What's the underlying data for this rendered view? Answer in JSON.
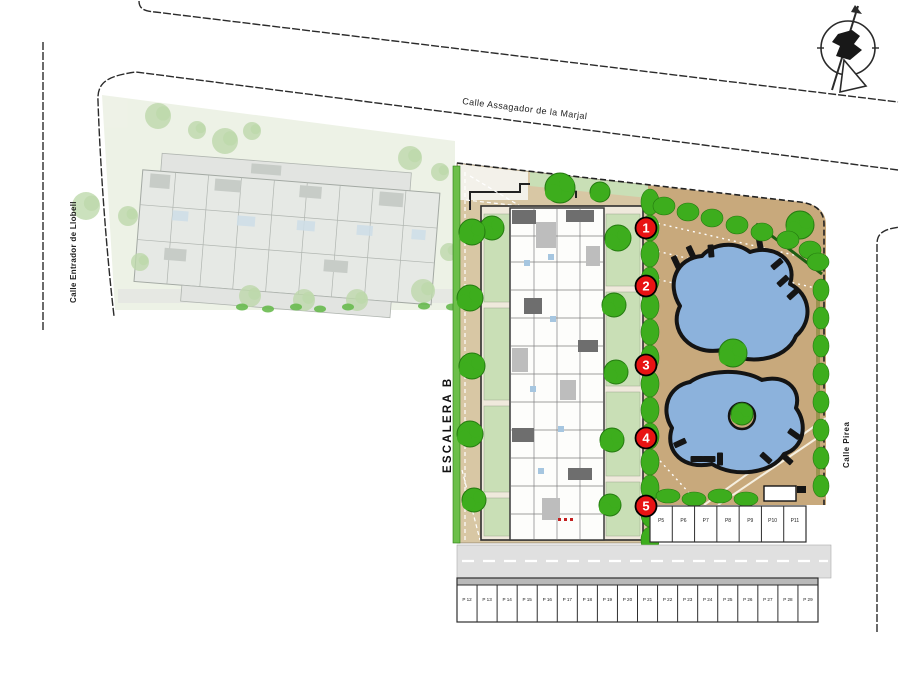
{
  "plan": {
    "staircase_label": "ESCALERA B",
    "unit_badges": [
      "1",
      "2",
      "3",
      "4",
      "5"
    ]
  },
  "streets": {
    "top": "Calle Assagador de la Marjal",
    "left": "Calle Entrador de Llobell",
    "right": "Calle Pirea"
  },
  "parking": {
    "upper_row": [
      "P5",
      "P6",
      "P7",
      "P8",
      "P9",
      "P10",
      "P11"
    ],
    "lower_row": [
      "P 12",
      "P 13",
      "P 14",
      "P 15",
      "P 16",
      "P 17",
      "P 18",
      "P 19",
      "P 20",
      "P 21",
      "P 22",
      "P 23",
      "P 24",
      "P 25",
      "P 26",
      "P 27",
      "P 28",
      "P 29"
    ]
  },
  "icons": {
    "compass": "north-arrow-icon"
  },
  "colors": {
    "terrace_tan": "#c8a97c",
    "path_tan": "#d8c7a4",
    "garden_green": "#c9dfb6",
    "hedge_green": "#6cbf4a",
    "tree_green": "#3dad1d",
    "tree_edge": "#247a10",
    "pool_blue": "#8cb2dc",
    "badge_red": "#e81313",
    "driveway_gray": "#e0e0e0",
    "faded_plot": "#ecf1e4",
    "faded_building": "#e4e7e3",
    "line_black": "#2b2b2b"
  }
}
